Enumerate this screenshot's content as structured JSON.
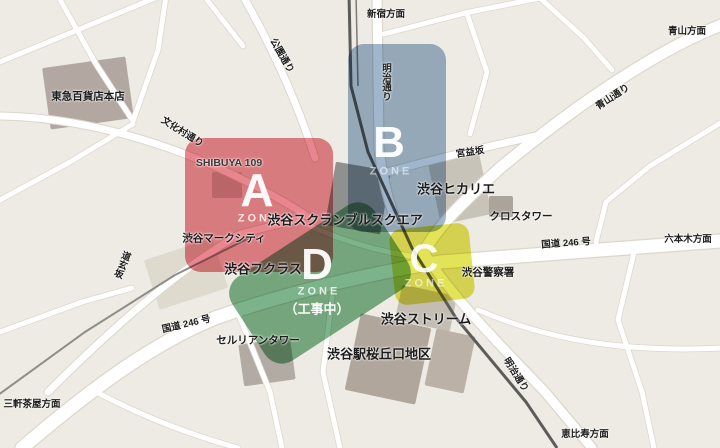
{
  "zones": {
    "a": {
      "letter": "A",
      "zone_word": "ZONE",
      "color": "#e5707a"
    },
    "b": {
      "letter": "B",
      "zone_word": "ZONE",
      "color": "#8fa9c4"
    },
    "c": {
      "letter": "C",
      "zone_word": "ZONE",
      "color": "#dede3a"
    },
    "d": {
      "letter": "D",
      "zone_word": "ZONE",
      "note": "（工事中）",
      "color": "#66a677"
    }
  },
  "landmarks": {
    "tokyu": "東急百貨店本店",
    "shibuya109": "SHIBUYA 109",
    "markcity": "渋谷マークシティ",
    "scramble": "渋谷スクランブルスクエア",
    "hikarie": "渋谷ヒカリエ",
    "crosstower": "クロスタワー",
    "police": "渋谷警察署",
    "fukuras": "渋谷フクラス",
    "stream": "渋谷ストリーム",
    "cerulean": "セルリアンタワー",
    "sakuragaoka": "渋谷駅桜丘口地区"
  },
  "streets": {
    "koendori": "公園通り",
    "meijidori_north": "明治通り",
    "bunkamuradori": "文化村通り",
    "miyamasuzaka": "宮益坂",
    "aoyamadori": "青山通り",
    "route246_east": "国道 246 号",
    "route246_west": "国道 246 号",
    "dogenzaka": "道玄坂",
    "meijidori_south": "明治通り"
  },
  "directions": {
    "shinjuku": "新宿方面",
    "aoyama": "青山方面",
    "roppongi": "六本木方面",
    "sangenjaya": "三軒茶屋方面",
    "ebisu": "恵比寿方面"
  },
  "colors": {
    "map_background": "#edebe4",
    "road": "#ffffff",
    "railway": "#5c5c5a"
  }
}
